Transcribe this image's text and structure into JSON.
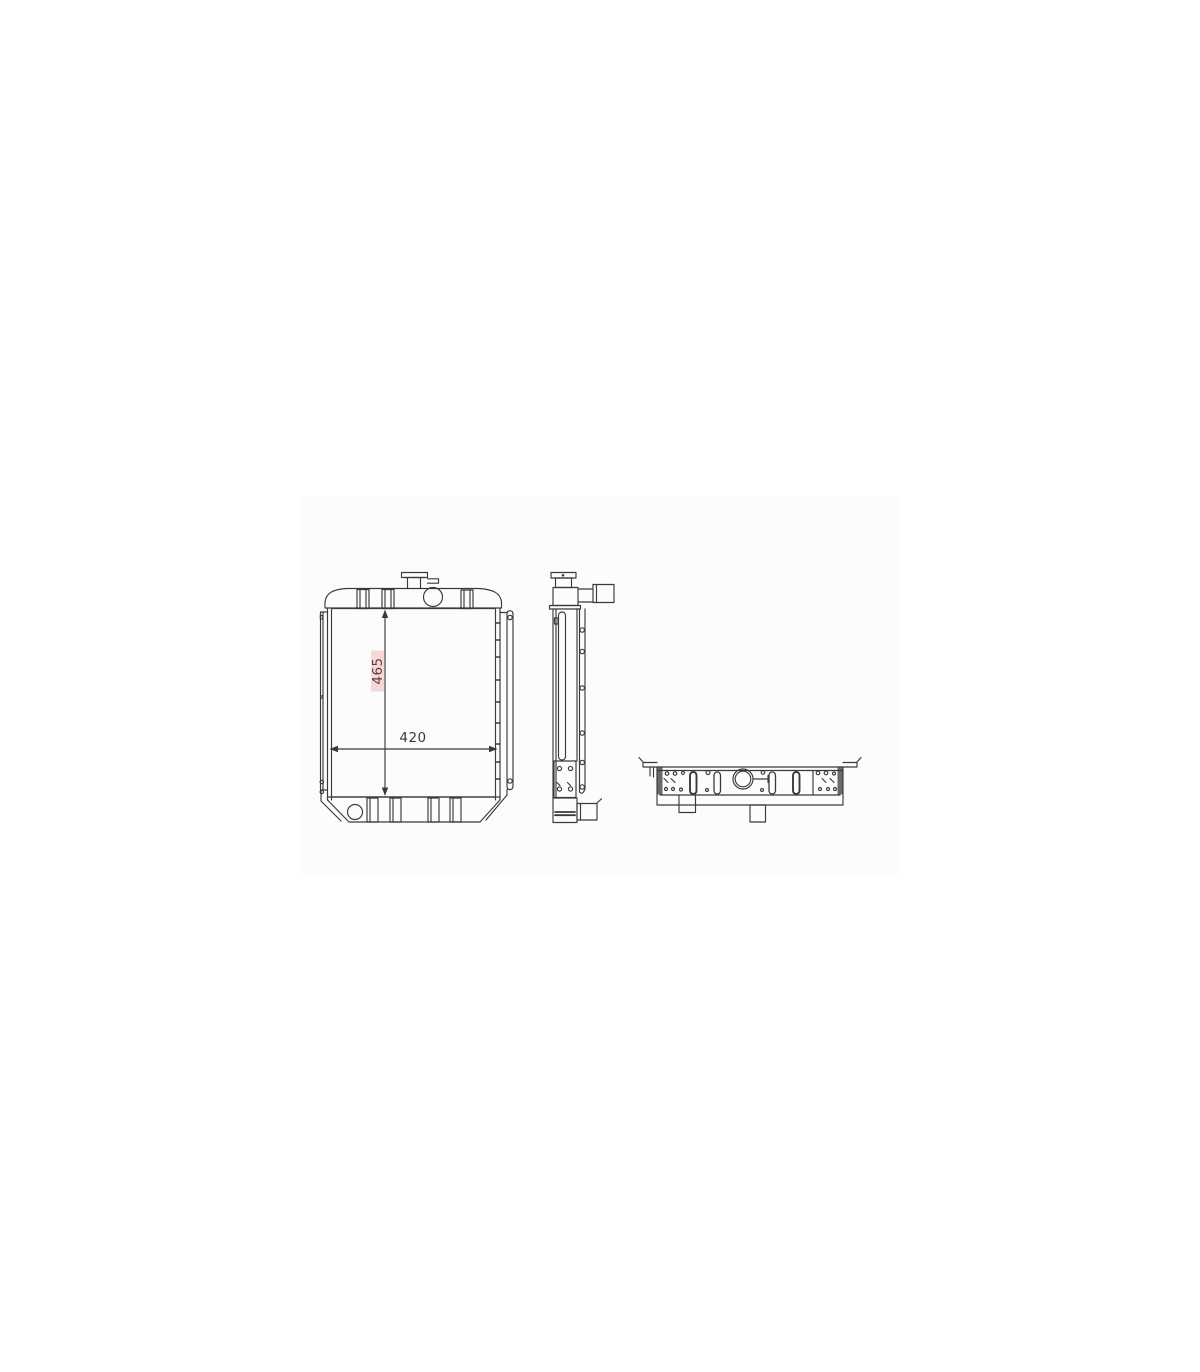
{
  "drawing": {
    "annotations": {
      "height_dim": {
        "value": "465",
        "text_color": "#6e3434",
        "highlight_color": "#f5d9da"
      },
      "width_dim": {
        "value": "420",
        "text_color": "#3a3a3a"
      }
    },
    "colors": {
      "line": "#3a3a3a",
      "scan_background": "#fcfcfd",
      "page_background": "#ffffff"
    }
  }
}
